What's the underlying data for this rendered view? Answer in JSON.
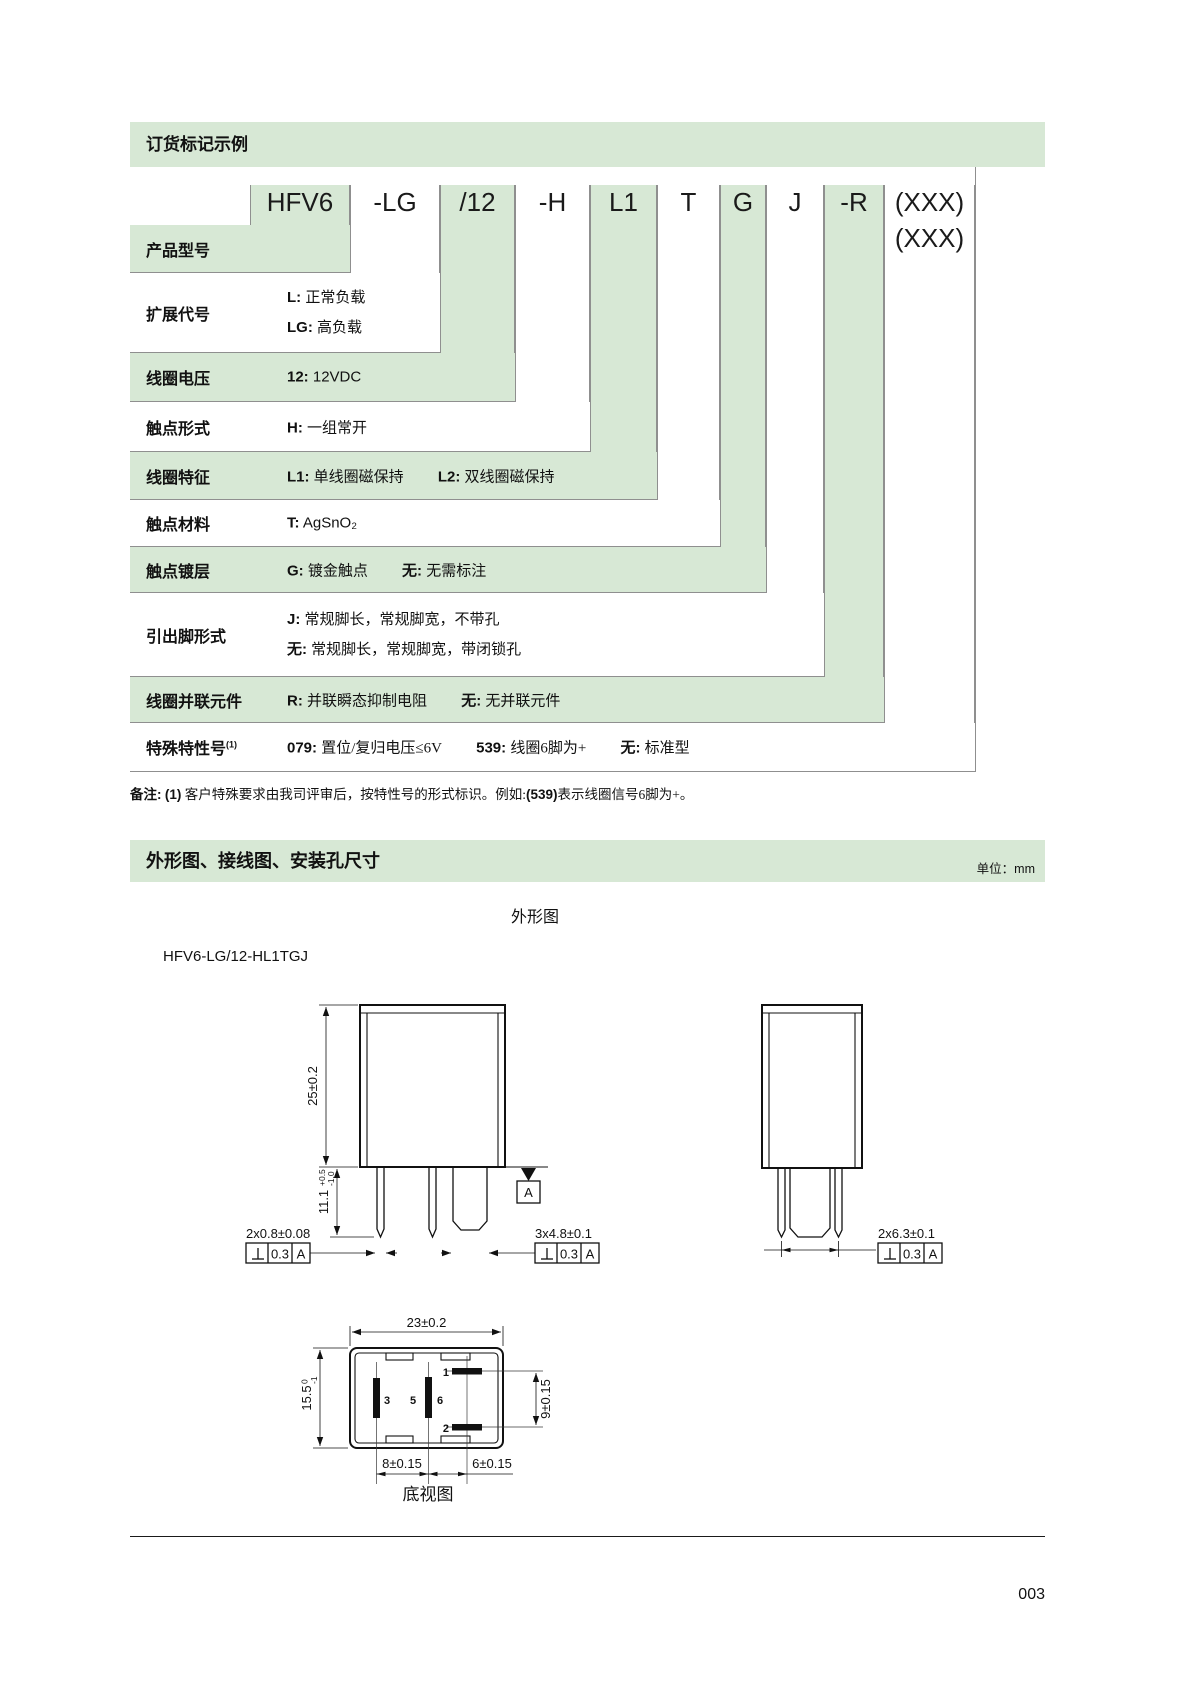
{
  "colors": {
    "band_green": "#d7e8d5"
  },
  "order": {
    "header": "订货标记示例",
    "code_segments": [
      "HFV6",
      "-LG",
      "/12",
      "-H",
      "L1",
      "T",
      "G",
      "J",
      "-R",
      "(XXX)"
    ],
    "code_line2": "(XXX)",
    "rows": [
      {
        "label": "产品型号"
      },
      {
        "label": "扩展代号",
        "items": [
          {
            "code": "L:",
            "desc": "正常负载"
          },
          {
            "code": "LG:",
            "desc": "高负载"
          }
        ]
      },
      {
        "label": "线圈电压",
        "items": [
          {
            "code": "12:",
            "desc": "12VDC"
          }
        ]
      },
      {
        "label": "触点形式",
        "items": [
          {
            "code": "H:",
            "desc": "一组常开"
          }
        ]
      },
      {
        "label": "线圈特征",
        "items": [
          {
            "code": "L1:",
            "desc": "单线圈磁保持"
          },
          {
            "code": "L2:",
            "desc": "双线圈磁保持"
          }
        ]
      },
      {
        "label": "触点材料",
        "items": [
          {
            "code": "T:",
            "desc": "AgSnO₂"
          }
        ]
      },
      {
        "label": "触点镀层",
        "items": [
          {
            "code": "G:",
            "desc": "镀金触点"
          },
          {
            "code": "无:",
            "desc": "无需标注"
          }
        ]
      },
      {
        "label": "引出脚形式",
        "items": [
          {
            "code": "J:",
            "desc": "常规脚长，常规脚宽，不带孔"
          },
          {
            "code": "无:",
            "desc": "常规脚长，常规脚宽，带闭锁孔"
          }
        ]
      },
      {
        "label": "线圈并联元件",
        "items": [
          {
            "code": "R:",
            "desc": "并联瞬态抑制电阻"
          },
          {
            "code": "无:",
            "desc": "无并联元件"
          }
        ]
      },
      {
        "label": "特殊特性号",
        "label_sup": "(1)",
        "items": [
          {
            "code": "079:",
            "desc": "置位/复归电压≤6V"
          },
          {
            "code": "539:",
            "desc": "线圈6脚为+"
          },
          {
            "code": "无:",
            "desc": "标准型"
          }
        ]
      }
    ],
    "note": {
      "prefix": "备注:",
      "num": "(1)",
      "body": "客户特殊要求由我司评审后，按特性号的形式标识。例如:",
      "code": "(539)",
      "tail": "表示线圈信号6脚为+。"
    }
  },
  "section2": {
    "header": "外形图、接线图、安装孔尺寸",
    "unit_label": "单位：",
    "unit_value": "mm"
  },
  "drawings": {
    "outline_title": "外形图",
    "model": "HFV6-LG/12-HL1TGJ",
    "bottom_view_label": "底视图",
    "front": {
      "height": "25±0.2",
      "pin_length": "11.1",
      "pin_length_tol_up": "+0.5",
      "pin_length_tol_dn": "-1.0",
      "small_pin_dim": "2x0.8±0.08",
      "blade_pin_dim": "3x4.8±0.1"
    },
    "side": {
      "pin_dim": "2x6.3±0.1"
    },
    "bottom": {
      "width": "23±0.2",
      "depth": "15.5",
      "depth_tol_up": "0",
      "depth_tol_dn": "-1",
      "coil_pin_pitch": "9±0.15",
      "pitch_left": "8±0.15",
      "pitch_right": "6±0.15",
      "pin1": "1",
      "pin2": "2",
      "pin3": "3",
      "pin5": "5",
      "pin6": "6"
    },
    "tolerance": {
      "value": "0.3",
      "datum": "A"
    }
  },
  "footer": {
    "page_number": "003"
  }
}
